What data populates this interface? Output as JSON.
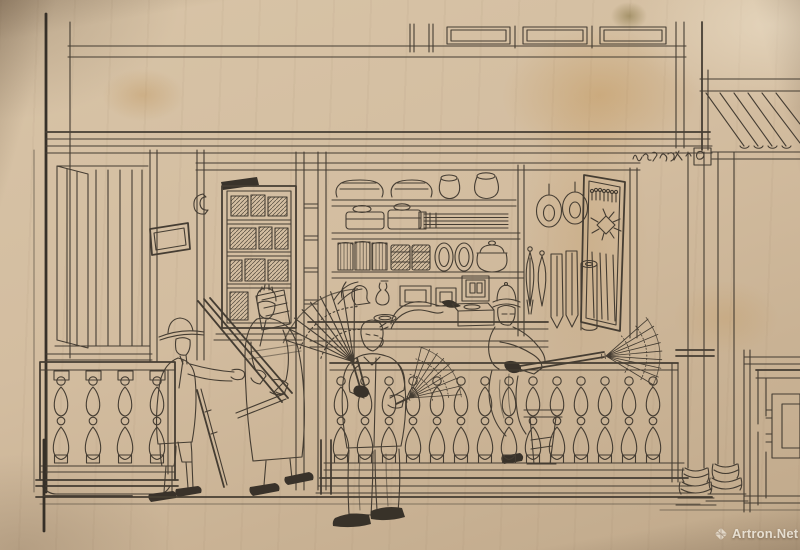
{
  "meta": {
    "title": "Pen-and-ink drawing of a Chinese shop front with feather-duster sellers",
    "medium": "ink line drawing on aged, stained cream paper"
  },
  "watermark": {
    "text": "Artron.Net",
    "logo": "artron-gem-logo"
  },
  "inscription": {
    "note": "small hand-written Chinese characters on the beam above the shop (illegible at this scale)"
  },
  "palette": {
    "paper": "#d2bd9f",
    "paper_light": "#e8dabd",
    "paper_shadow": "#b49d7f",
    "stain": "#ba843a",
    "ink": "#3b342b",
    "ink_dark": "#2c2720",
    "watermark_text": "rgba(248,243,232,0.82)"
  },
  "scene": {
    "description": "Chinese export-style ink drawing: a shop front with shelves of wares, a balustrade, four figures (a European customer, a robed assistant, a street seller carrying large feather dusters, and a shopkeeper leaning over the railing), columns and a tiled awning at right.",
    "elements": {
      "upper_balcony": "Upper storey balcony rail with three rectangular openwork panels",
      "signboard_beam": "Beam with small hand-written Chinese shop inscription",
      "tiled_awning": "Tiled roof awning at upper right",
      "left_wall": "Plank wall with partly opened door at left",
      "shop_plaque": "Small rectangular plaque hung on the left post",
      "left_balustrade": "Left balustrade panel with vase-shaped balusters",
      "left_cabinet": "Display cabinet filled with small wares",
      "center_posts": "Central door posts with ladder rungs",
      "shelves": "Shelves stocked with folded goods, jars, covered boxes, bundled sticks, stacked containers, plates and a covered tureen",
      "counter": "Counter with dish, long curved pipe and lidded box",
      "right_display": "Hanging hats, fly-whisks, cloth strips, rolled mat and opened shutter with ornaments",
      "shopkeeper": "Shopkeeper on a stool leaning over the balustrade, holding out a feather duster",
      "balustrade": "Long balustrade of vase-shaped balusters across the shop front",
      "shop_assistant": "Robed shop assistant holding a bundle of long duster handles",
      "european_customer": "European man in hat and long coat inspecting the handles, cane under his arm",
      "duster_seller": "Street seller carrying a large feather duster over his shoulder and another in his hand",
      "columns": "Two round columns with moulded bases",
      "lattice_panel": "Geometric lattice panel at the far right",
      "ground": "Platform step and street ground lines"
    }
  }
}
